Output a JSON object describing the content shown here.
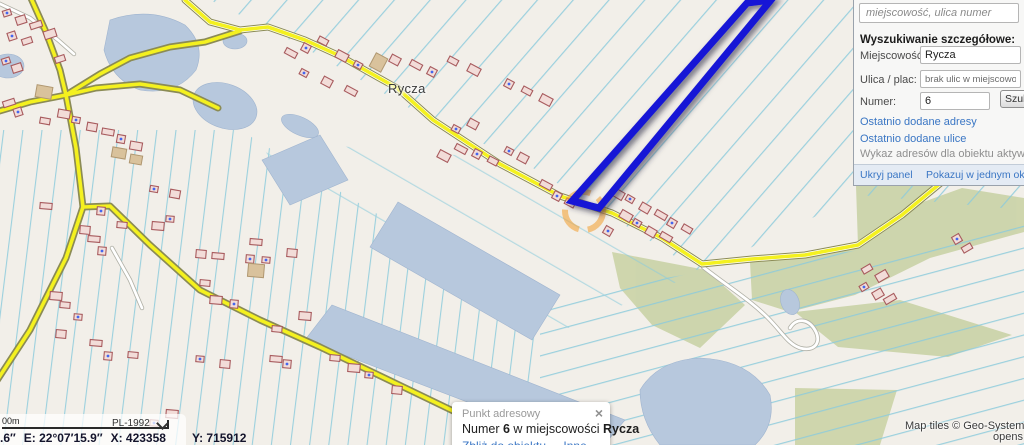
{
  "map": {
    "place_label": "Rycza",
    "attribution": {
      "line1": "Map tiles © Geo-System; Map",
      "line2": "opens"
    },
    "colors": {
      "land": "#f2efe9",
      "water": "#b7c8dd",
      "forest": "#ccd4aa",
      "field_line": "#8ccbdc",
      "road_fill": "#f4f11f",
      "road_casing": "#8b8b55",
      "building_fill": "#f2dcd8",
      "building_stroke": "#a85b5e",
      "selection_blue": "#1616d6",
      "highlight_orange": "#f2a33c",
      "link_blue": "#3a76c4"
    }
  },
  "search_panel": {
    "query_placeholder": "miejscowość, ulica numer",
    "section_title": "Wyszukiwanie szczegółowe:",
    "miejscowosc_label": "Miejscowość:",
    "miejscowosc_value": "Rycza",
    "ulica_label": "Ulica / plac:",
    "ulica_value": "brak ulic w miejscowości",
    "numer_label": "Numer:",
    "numer_value": "6",
    "search_button": "Szuk",
    "link_recent_addresses": "Ostatnio dodane adresy",
    "link_recent_streets": "Ostatnio dodane ulice",
    "note": "Wykaz adresów dla obiektu aktywnego l",
    "footer_hide": "Ukryj panel",
    "footer_single_window": "Pokazuj w jednym oknie"
  },
  "popup": {
    "title": "Punkt adresowy",
    "close_icon": "×",
    "text_prefix": "Numer ",
    "number": "6",
    "text_middle": " w miejscowości ",
    "place": "Rycza",
    "link_zoom": "Zbliż do obiektu",
    "link_other": "Inne"
  },
  "status_bar": {
    "scale_label": "00m",
    "crs": "PL-1992",
    "coord_lat_fragment": ".6″",
    "coord_lon": "E: 22°07′15.9″",
    "coord_x": "X: 423358",
    "coord_y": "Y: 715912"
  }
}
